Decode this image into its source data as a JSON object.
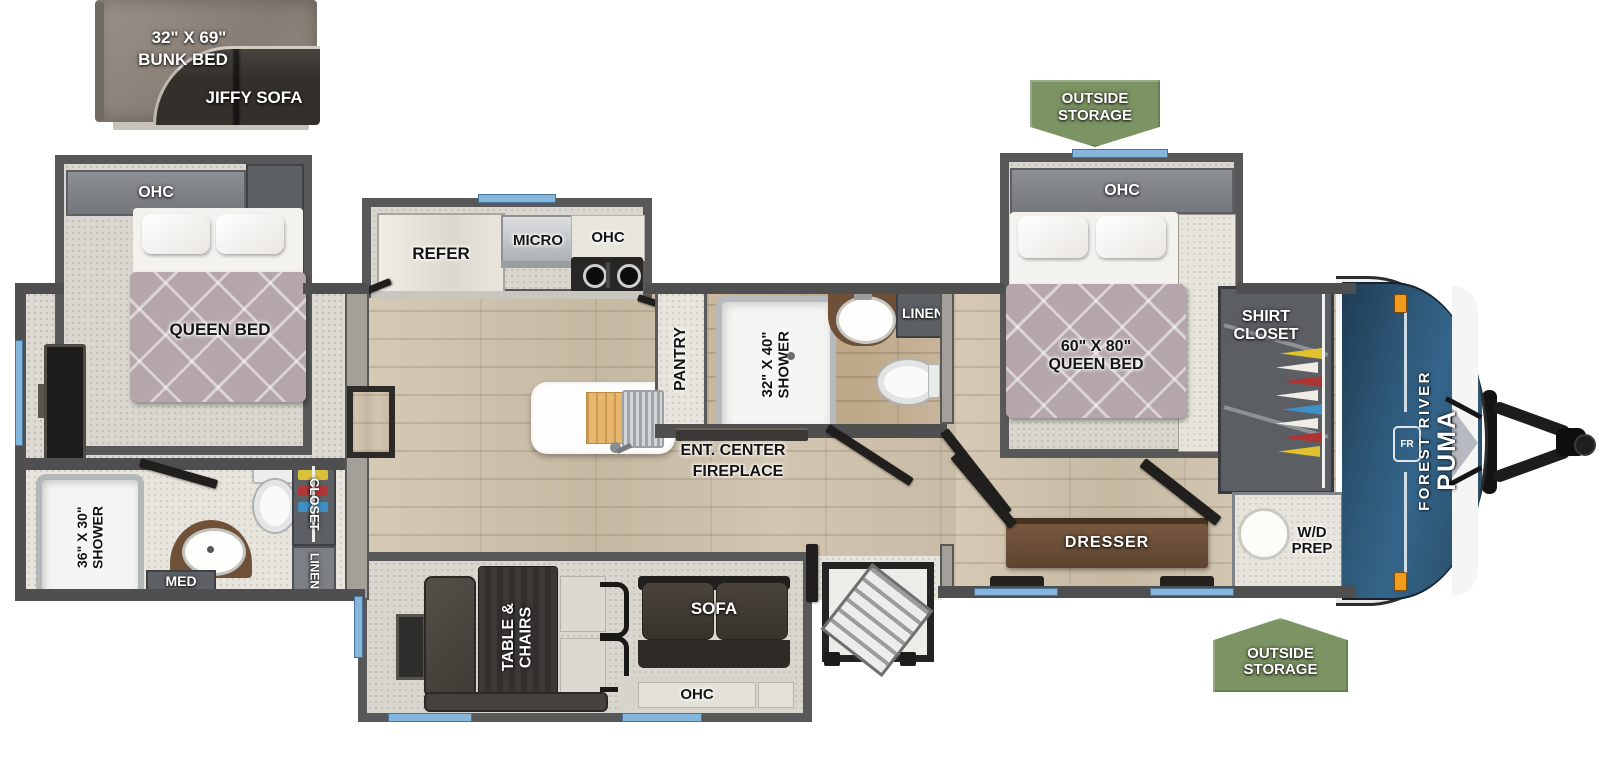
{
  "inset_bunk": {
    "size": "32\" X 69\"",
    "name": "BUNK BED",
    "sofa": "JIFFY SOFA"
  },
  "callouts": {
    "outside_storage_top": "OUTSIDE\nSTORAGE",
    "outside_storage_bottom": "OUTSIDE\nSTORAGE"
  },
  "rear_bedroom": {
    "ohc": "OHC",
    "linen": "LINEN",
    "bed": "QUEEN BED"
  },
  "rear_bath": {
    "shower": "36\" X 30\"\nSHOWER",
    "med": "MED",
    "closet": "CLOSET",
    "linen": "LINEN"
  },
  "kitchen": {
    "refer": "REFER",
    "micro": "MICRO",
    "ohc": "OHC",
    "pantry": "PANTRY"
  },
  "mid_bath": {
    "shower": "32\" X 40\"\nSHOWER",
    "linen": "LINEN"
  },
  "living": {
    "ent_center": "ENT. CENTER",
    "fireplace": "FIREPLACE",
    "dinette": "TABLE &\nCHAIRS",
    "sofa": "SOFA",
    "ohc": "OHC"
  },
  "front_bedroom": {
    "ohc": "OHC",
    "bed": "60\" X 80\"\nQUEEN BED",
    "shirt_closet": "SHIRT\nCLOSET",
    "dresser": "DRESSER",
    "wd_prep": "W/D\nPREP"
  },
  "brand": {
    "make": "FOREST RIVER",
    "model": "PUMA",
    "logo": "FR"
  },
  "colors": {
    "banner_green": "#7c9363",
    "cap_blue": "#2e5878",
    "window_blue": "#84b7db",
    "bed_mauve": "#b4a6aa",
    "wall_dark": "#4f4f4f"
  }
}
